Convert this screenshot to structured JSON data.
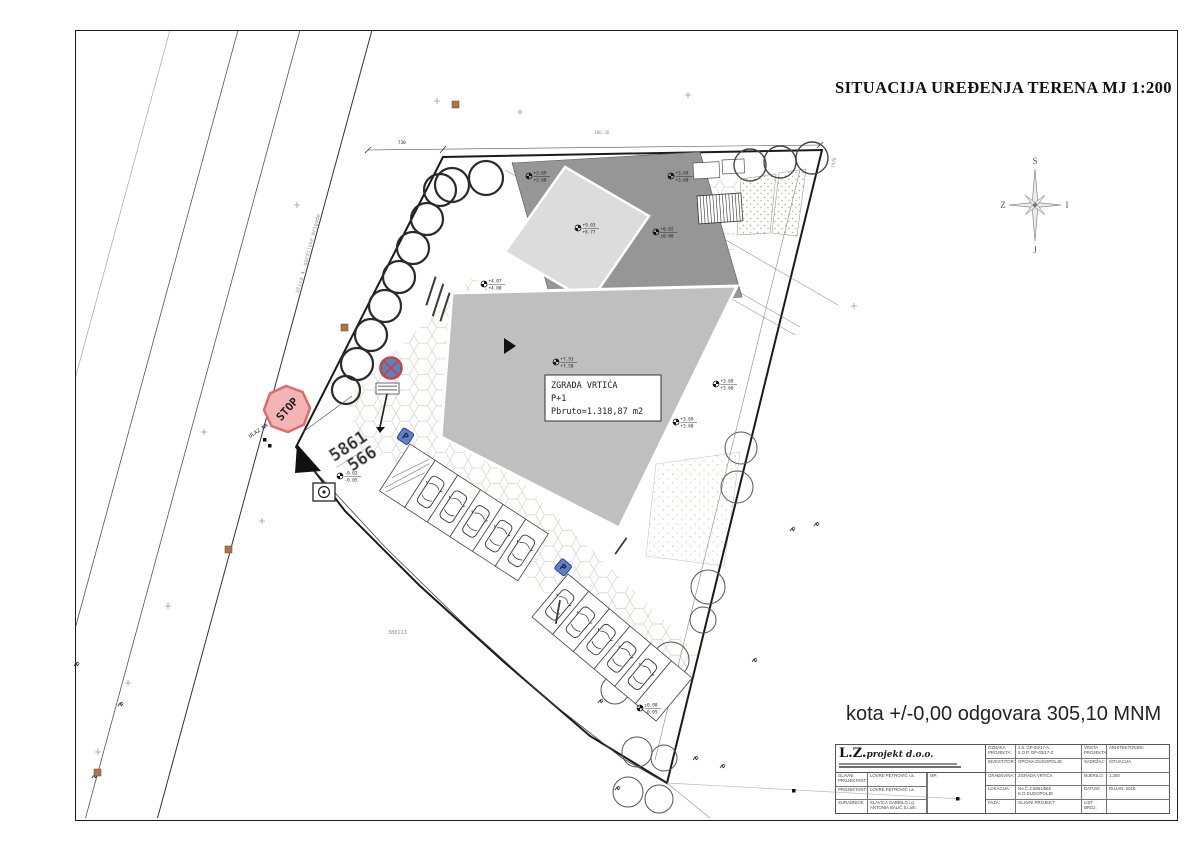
{
  "sheet": {
    "title": "SITUACIJA UREĐENJA TERENA  MJ 1:200",
    "level_note": "kota +/-0,00 odgovara 305,10 MNM"
  },
  "compass": {
    "north": "S",
    "south": "J",
    "west": "Z",
    "east": "I"
  },
  "plan": {
    "street_name": "Ulica 4. gardijske brigade",
    "entrance_label": "ULAZ NA PARCELU",
    "stop_sign_label": "STOP",
    "parking_sign_label": "P",
    "parcel_number_top": "5861",
    "parcel_number_bottom": "566",
    "geodetic_point": "380113",
    "spot_height": "306.36",
    "dim_top": "730",
    "dim_right": "1428",
    "building": {
      "name": "ZGRADA VRTIĆA",
      "floors": "P+1",
      "area": "Pbruto=1.318,87 m2"
    },
    "elevation_markers": [
      {
        "x": 529,
        "y": 176,
        "top": "+3.69",
        "bottom": "+3.60"
      },
      {
        "x": 671,
        "y": 176,
        "top": "+3.69",
        "bottom": "+3.60"
      },
      {
        "x": 578,
        "y": 228,
        "top": "+9.03",
        "bottom": "+8.77"
      },
      {
        "x": 556,
        "y": 362,
        "top": "+7.93",
        "bottom": "+7.58"
      },
      {
        "x": 484,
        "y": 284,
        "top": "+4.07",
        "bottom": "+4.00"
      },
      {
        "x": 716,
        "y": 384,
        "top": "+3.69",
        "bottom": "+3.60"
      },
      {
        "x": 676,
        "y": 422,
        "top": "+3.69",
        "bottom": "+3.60"
      },
      {
        "x": 656,
        "y": 232,
        "top": "+0.02",
        "bottom": "±0.00"
      },
      {
        "x": 340,
        "y": 476,
        "top": "-0.02",
        "bottom": "-0.05"
      },
      {
        "x": 640,
        "y": 708,
        "top": "±0.00",
        "bottom": "-0.05"
      }
    ]
  },
  "titleblock": {
    "logo_main": "L.Z.",
    "logo_script": "projekt d.o.o.",
    "stamp_label": "MP.",
    "left_rows": [
      {
        "label": "GLAVNI PROJEKTANT:",
        "value": "LOVRE PETROVIĆ i.a."
      },
      {
        "label": "PROJEKTANT:",
        "value": "LOVRE PETROVIĆ i.a."
      },
      {
        "label": "SURADNICE:",
        "value": "SLAVICA GABRILO i.g.",
        "value2": "ANTONIA BALIĆ b.i.arh."
      }
    ],
    "right_rows": [
      {
        "label": "OZNAKA PROJEKTA:",
        "value": "1.0. GP-03/17-A,",
        "value2": "2.O.P. GP-03/17-Z",
        "label2": "VRSTA PROJEKTA:",
        "rvalue": "ARHITEKTONSKI"
      },
      {
        "label": "INVESTITOR:",
        "value": "OPĆINA DUGOPOLJE",
        "label2": "SADRŽAJ:",
        "rvalue": "SITUACIJA"
      },
      {
        "label": "GRAĐEVINA:",
        "value": "ZGRADA VRTIĆA",
        "label2": "MJERILO:",
        "rvalue": "1:200"
      },
      {
        "label": "LOKACIJA:",
        "value": "NA Č.Z.5861/566",
        "value2": "K.O.DUGOPOLJE",
        "label2": "DATUM:",
        "rvalue": "RUJAN, 2018."
      },
      {
        "label": "FAZA:",
        "value": "GLAVNI PROJEKT",
        "label2": "LIST BROJ:",
        "rvalue": ""
      }
    ]
  }
}
